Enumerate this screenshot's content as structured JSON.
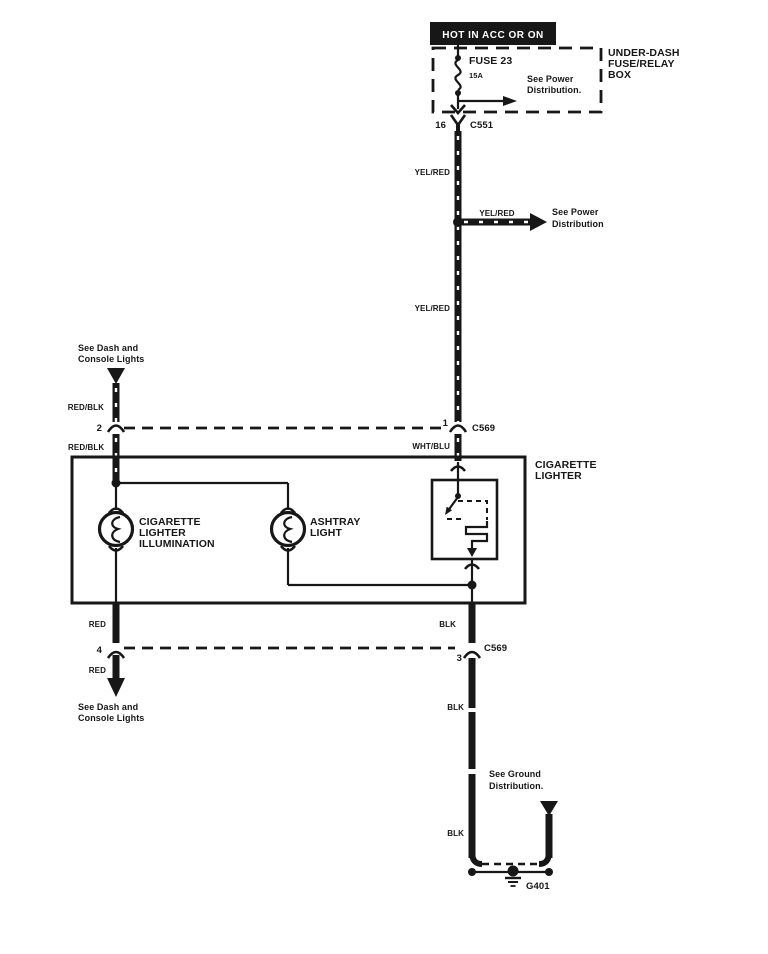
{
  "diagram": {
    "banner": "HOT IN ACC OR ON",
    "fuse_box_title": [
      "UNDER-DASH",
      "FUSE/RELAY",
      "BOX"
    ],
    "fuse_name": "FUSE 23",
    "fuse_rating": "15A",
    "fuse_note": [
      "See Power",
      "Distribution."
    ],
    "branch_note": [
      "See Power",
      "Distribution"
    ],
    "dash_note_top": [
      "See Dash and",
      "Console Lights"
    ],
    "dash_note_bottom": [
      "See Dash and",
      "Console Lights"
    ],
    "ground_note": [
      "See Ground",
      "Distribution."
    ],
    "component_box_label": [
      "CIGARETTE",
      "LIGHTER"
    ],
    "bulb_left_label": [
      "CIGARETTE",
      "LIGHTER",
      "ILLUMINATION"
    ],
    "bulb_right_label": [
      "ASHTRAY",
      "LIGHT"
    ],
    "connectors": {
      "c551": {
        "name": "C551",
        "pin": "16"
      },
      "c569_top": {
        "name": "C569",
        "pin_left": "2",
        "pin_right": "1"
      },
      "c569_bottom": {
        "name": "C569",
        "pin_left": "4",
        "pin_right": "3"
      }
    },
    "ground_id": "G401",
    "wire_labels": {
      "yelred_upper": "YEL/RED",
      "yelred_branch": "YEL/RED",
      "yelred_lower": "YEL/RED",
      "redblk_upper": "RED/BLK",
      "redblk_lower": "RED/BLK",
      "whtblu": "WHT/BLU",
      "red_upper": "RED",
      "red_lower": "RED",
      "blk_upper": "BLK",
      "blk_mid": "BLK",
      "blk_lower": "BLK"
    },
    "colors": {
      "ink": "#171717",
      "paper": "#ffffff"
    }
  }
}
